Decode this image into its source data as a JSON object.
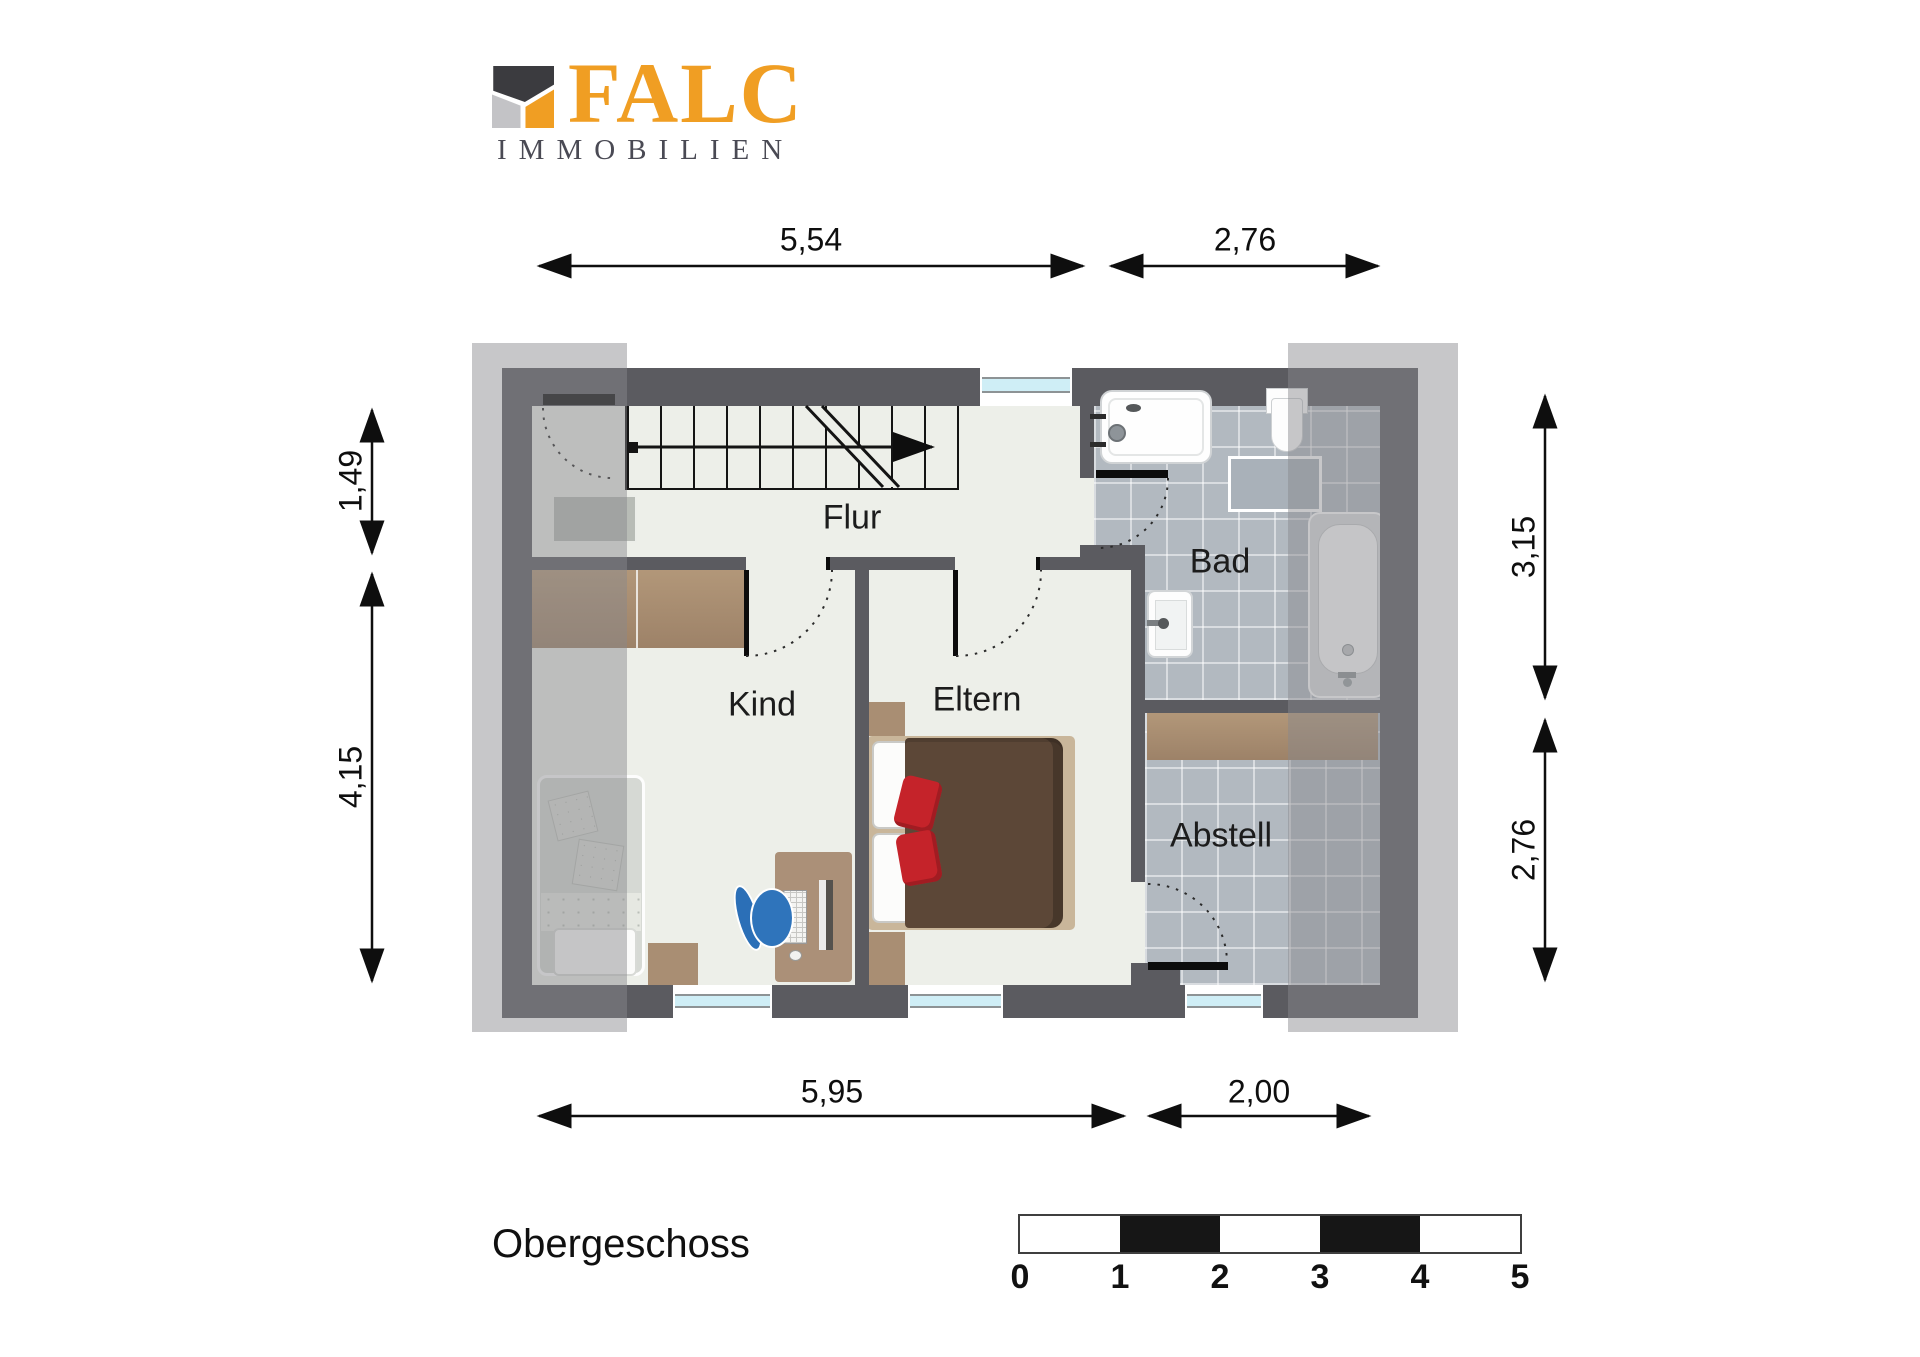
{
  "brand": {
    "title": "FALC",
    "subtitle": "IMMOBILIEN"
  },
  "floor_label": "Obergeschoss",
  "rooms": [
    {
      "label": "Flur"
    },
    {
      "label": "Kind"
    },
    {
      "label": "Eltern"
    },
    {
      "label": "Bad"
    },
    {
      "label": "Abstell"
    }
  ],
  "dimensions": {
    "top_left": "5,54",
    "top_right": "2,76",
    "left_upper": "1,49",
    "left_lower": "4,15",
    "right_upper": "3,15",
    "right_lower": "2,76",
    "bottom_left": "5,95",
    "bottom_right": "2,00"
  },
  "scalebar": {
    "ticks": [
      "0",
      "1",
      "2",
      "3",
      "4",
      "5"
    ]
  },
  "colors": {
    "brand_orange": "#F09E23",
    "brand_dark": "#3B3B3F",
    "brand_gray": "#C3C3C6",
    "wall": "#5B5B60",
    "floor": "#EDEFE9",
    "tile": "#B2B9C0",
    "roof_overlay": "rgba(136,136,140,0.47)",
    "window_glass": "#CFEEF6",
    "accent_red": "#C5232A",
    "wood": "#A3876D"
  }
}
